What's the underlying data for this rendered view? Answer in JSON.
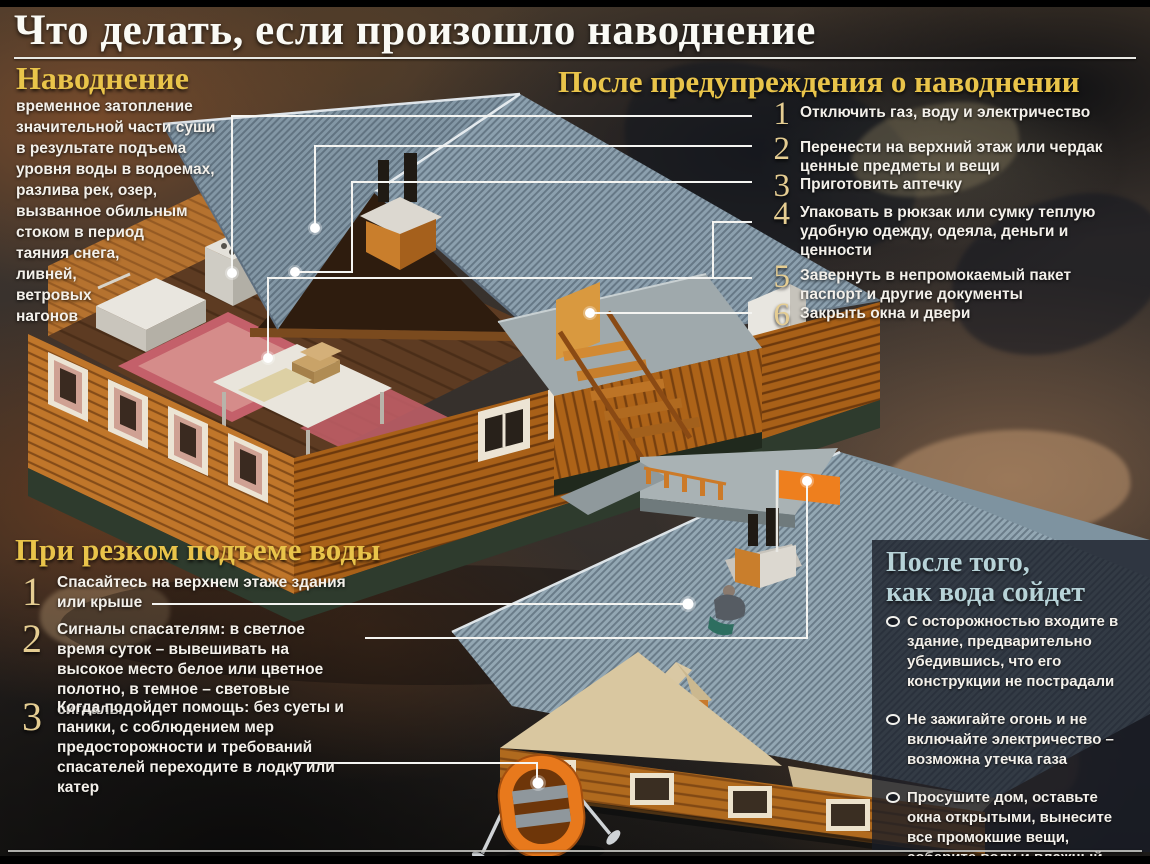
{
  "title": "Что делать, если произошло наводнение",
  "definition": {
    "heading": "Наводнение",
    "body": "временное затопление значительной части суши в результате подъема уровня воды в водоемах, разлива рек, озер, вызванное обильным стоком в период таяния снега, ливней, ветровых нагонов"
  },
  "after_warning": {
    "heading": "После предупреждения о наводнении",
    "items": [
      {
        "num": "1",
        "text": "Отключить газ, воду и электричество"
      },
      {
        "num": "2",
        "text": "Перенести на верхний этаж или чердак ценные предметы и вещи"
      },
      {
        "num": "3",
        "text": "Приготовить аптечку"
      },
      {
        "num": "4",
        "text": "Упаковать в рюкзак или сумку теплую удобную одежду, одеяла, деньги и ценности"
      },
      {
        "num": "5",
        "text": "Завернуть в непромокаемый пакет паспорт и другие документы"
      },
      {
        "num": "6",
        "text": "Закрыть окна и двери"
      }
    ]
  },
  "sudden_rise": {
    "heading": "При резком подъеме воды",
    "items": [
      {
        "num": "1",
        "text": "Спасайтесь на верхнем этаже здания или крыше"
      },
      {
        "num": "2",
        "text": "Сигналы спасателям: в светлое время суток – вывешивать на высокое место белое или цветное полотно, в темное – световые сигналы"
      },
      {
        "num": "3",
        "text": "Когда подойдет помощь: без суеты и паники, с соблюдением мер предосторожности и требований спасателей переходите в лодку или катер"
      }
    ]
  },
  "after_water": {
    "heading_lines": [
      "После того,",
      "как вода сойдет"
    ],
    "items": [
      "С осторожностью входите в здание, предварительно убедившись, что его конструкции не пострадали",
      "Не зажигайте огонь и не включайте электричество – возможна утечка газа",
      "Просушите дом, оставьте окна открытыми, вынесите все промокшие вещи, соберите воду и влажный мусор"
    ]
  },
  "illustrations": {
    "main_house": "cutaway-wooden-house",
    "flooded_house": "flooded-house-with-person-on-roof",
    "boat": "inflatable-rescue-boat",
    "flag": "orange-signal-flag",
    "bullet": "ring-bullet-icon"
  },
  "colors": {
    "accent_gold": "#e9c44a",
    "accent_blue": "#b7d3d8",
    "number_tan": "#e5cd92",
    "text_white": "#f3f0ea",
    "roof_gray": "#8ca0ae",
    "wall_orange": "#c0762a",
    "flag_orange": "#ee7f1e",
    "boat_orange": "#e8791c",
    "panel_dark": "#181c26"
  }
}
